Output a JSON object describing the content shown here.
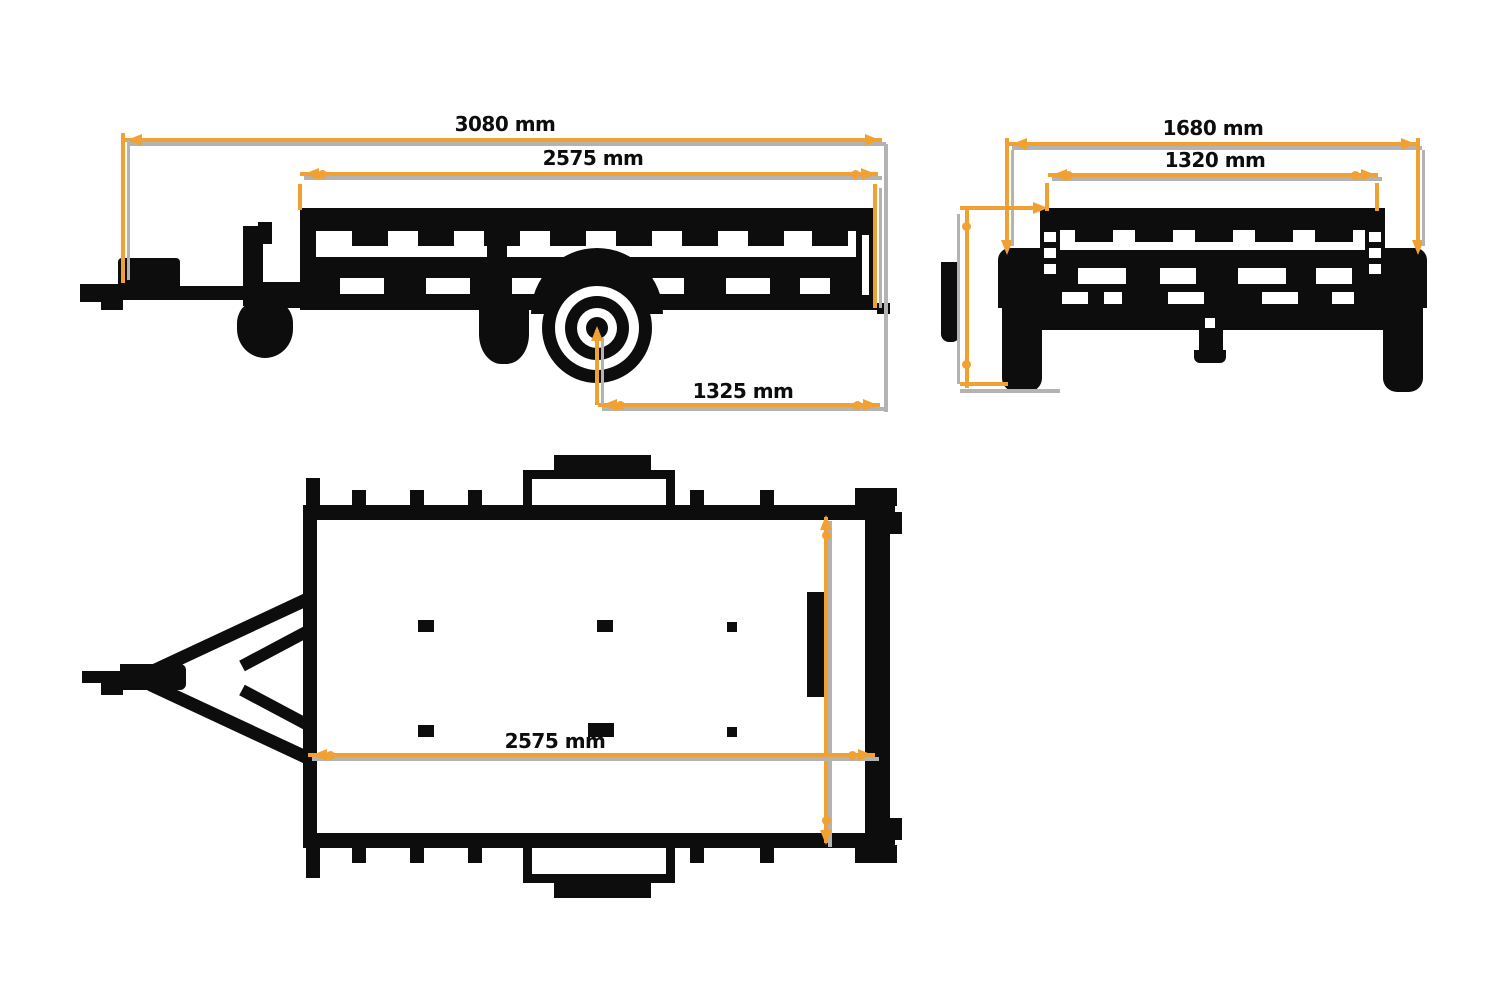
{
  "dimensions": {
    "side_view": {
      "overall_length": "3080 mm",
      "box_length": "2575 mm",
      "axle_to_rear": "1325 mm"
    },
    "rear_view": {
      "overall_width": "1680 mm",
      "internal_width": "1320 mm"
    },
    "top_view": {
      "box_length": "2575 mm"
    }
  },
  "colors": {
    "dimension_line": "#F1A131",
    "extension_line": "#B3B3B3",
    "drawing_line": "#0D0D0D",
    "background": "#FFFFFF"
  }
}
